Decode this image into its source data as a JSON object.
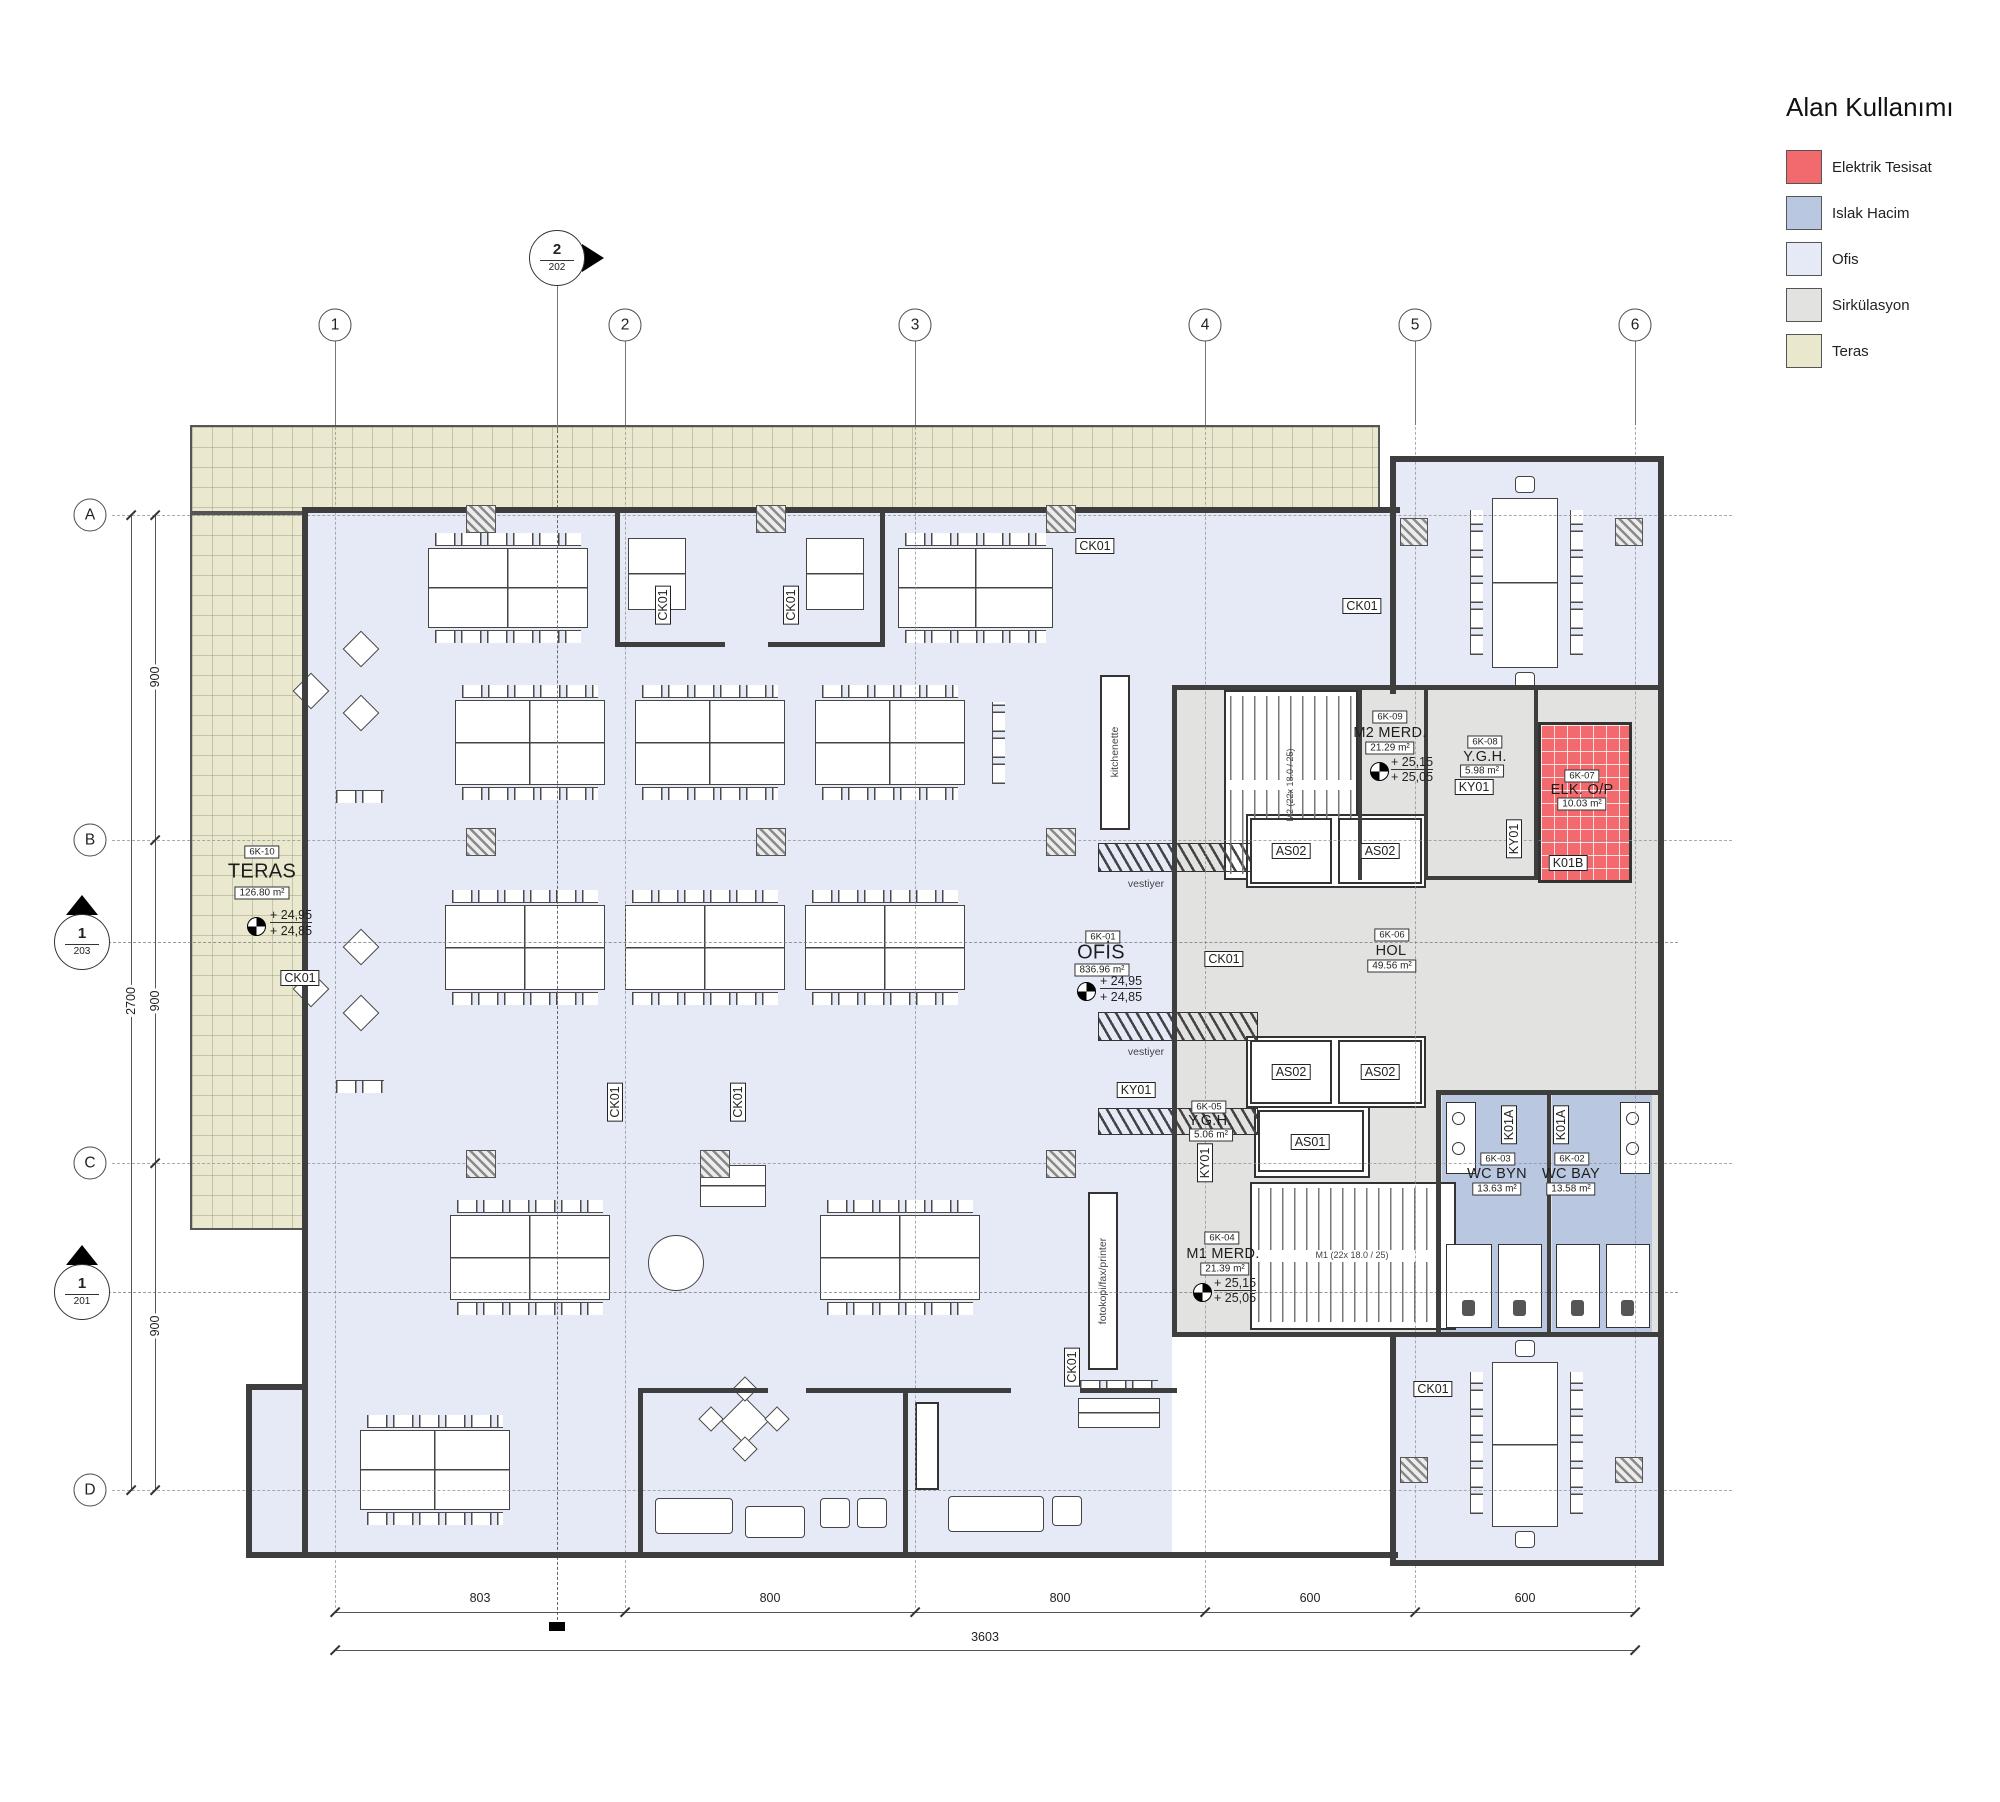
{
  "legend": {
    "title": "Alan Kullanımı",
    "items": [
      {
        "label": "Elektrik Tesisat",
        "color": "#F2696E"
      },
      {
        "label": "Islak Hacim",
        "color": "#B9C7E0"
      },
      {
        "label": "Ofis",
        "color": "#E6EAF7"
      },
      {
        "label": "Sirkülasyon",
        "color": "#E2E2E0"
      },
      {
        "label": "Teras",
        "color": "#E9E7CC"
      }
    ]
  },
  "grid": {
    "columns": [
      "1",
      "2",
      "3",
      "4",
      "5",
      "6"
    ],
    "rows": [
      "A",
      "B",
      "C",
      "D"
    ]
  },
  "sections": {
    "top": {
      "number": "2",
      "sheet": "202"
    },
    "left_upper": {
      "number": "1",
      "sheet": "203"
    },
    "left_lower": {
      "number": "1",
      "sheet": "201"
    }
  },
  "dimensions": {
    "bottom_segments": [
      "803",
      "800",
      "800",
      "600",
      "600"
    ],
    "bottom_total": "3603",
    "left_segments": [
      "900",
      "900",
      "900"
    ],
    "left_total": "2700"
  },
  "rooms": {
    "teras": {
      "code": "6K-10",
      "name": "TERAS",
      "area": "126.80 m²",
      "elev_upper": "+ 24,95",
      "elev_lower": "+ 24,85"
    },
    "ofis": {
      "code": "6K-01",
      "name": "OFİS",
      "area": "836.96 m²",
      "elev_upper": "+ 24,95",
      "elev_lower": "+ 24,85"
    },
    "hol": {
      "code": "6K-06",
      "name": "HOL",
      "area": "49.56 m²"
    },
    "m2_merd": {
      "code": "6K-09",
      "name": "M2 MERD.",
      "area": "21.29 m²",
      "elev_upper": "+ 25,15",
      "elev_lower": "+ 25,05"
    },
    "ygh_upper": {
      "code": "6K-08",
      "name": "Y.G.H.",
      "area": "5.98 m²"
    },
    "elk": {
      "code": "6K-07",
      "name": "ELK. O/P",
      "area": "10.03 m²"
    },
    "wc_byn": {
      "code": "6K-03",
      "name": "WC BYN",
      "area": "13.63 m²"
    },
    "wc_bay": {
      "code": "6K-02",
      "name": "WC BAY",
      "area": "13.58 m²"
    },
    "m1_merd": {
      "code": "6K-04",
      "name": "M1 MERD.",
      "area": "21.39 m²",
      "elev_upper": "+ 25,15",
      "elev_lower": "+ 25,05"
    },
    "ygh_lower": {
      "code": "6K-05",
      "name": "Y.G.H.",
      "area": "5.06 m²"
    }
  },
  "tags": {
    "as01": "AS01",
    "as02": "AS02",
    "ck01": "CK01",
    "ky01": "KY01",
    "k01a": "K01A",
    "k01b": "K01B"
  },
  "annotations": {
    "kitchenette": "kitchenette",
    "vestiyer": "vestiyer",
    "fotokopi": "fotokopi/fax/printer",
    "m1_stair_note": "M1 (22x 18.0 / 25)",
    "m2_stair_note": "M2 (22x 18.0 / 25)"
  }
}
